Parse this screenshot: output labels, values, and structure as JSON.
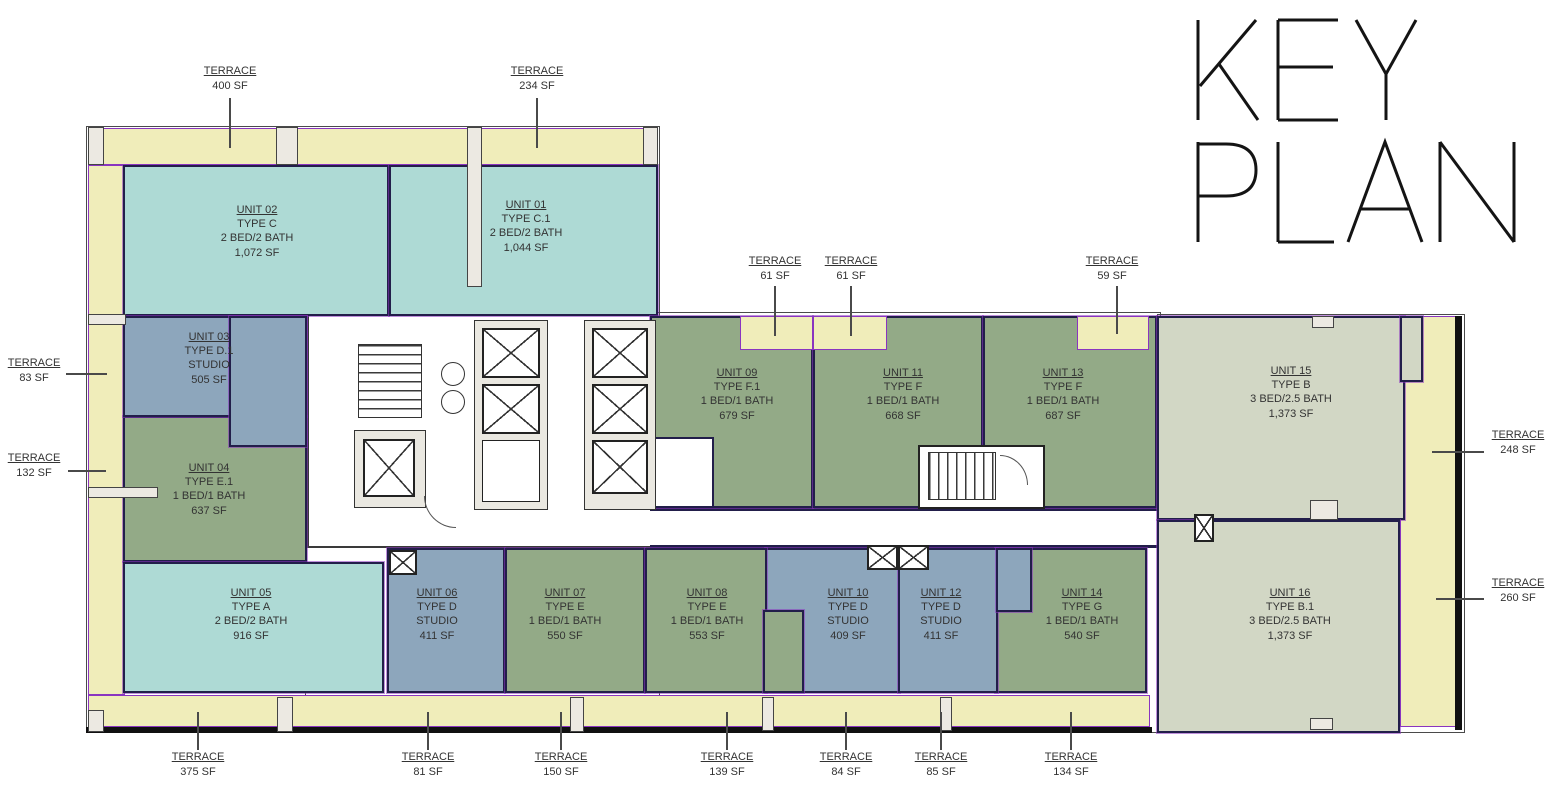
{
  "title": {
    "text": "KEY PLAN",
    "line1": "KEY",
    "line2": "PLAN"
  },
  "colors": {
    "teal": "#aedad5",
    "blue_gray": "#8da6bc",
    "green": "#93aa87",
    "sage": "#d2d7c5",
    "terrace_fill": "#f0edba",
    "wall_navy": "#221e4a",
    "outline_purple": "#8a35c0",
    "label_text": "#333333"
  },
  "units": [
    {
      "name": "UNIT 01",
      "type": "TYPE C.1",
      "layout": "2 BED/2 BATH",
      "area": "1,044 SF",
      "color": "teal"
    },
    {
      "name": "UNIT 02",
      "type": "TYPE C",
      "layout": "2 BED/2 BATH",
      "area": "1,072 SF",
      "color": "teal"
    },
    {
      "name": "UNIT 03",
      "type": "TYPE D.1",
      "layout": "STUDIO",
      "area": "505 SF",
      "color": "blue_gray"
    },
    {
      "name": "UNIT 04",
      "type": "TYPE E.1",
      "layout": "1 BED/1 BATH",
      "area": "637 SF",
      "color": "green"
    },
    {
      "name": "UNIT 05",
      "type": "TYPE A",
      "layout": "2 BED/2 BATH",
      "area": "916 SF",
      "color": "teal"
    },
    {
      "name": "UNIT 06",
      "type": "TYPE D",
      "layout": "STUDIO",
      "area": "411 SF",
      "color": "blue_gray"
    },
    {
      "name": "UNIT 07",
      "type": "TYPE E",
      "layout": "1 BED/1 BATH",
      "area": "550 SF",
      "color": "green"
    },
    {
      "name": "UNIT 08",
      "type": "TYPE E",
      "layout": "1 BED/1 BATH",
      "area": "553 SF",
      "color": "green"
    },
    {
      "name": "UNIT 09",
      "type": "TYPE F.1",
      "layout": "1 BED/1 BATH",
      "area": "679 SF",
      "color": "green"
    },
    {
      "name": "UNIT 10",
      "type": "TYPE D",
      "layout": "STUDIO",
      "area": "409 SF",
      "color": "blue_gray"
    },
    {
      "name": "UNIT 11",
      "type": "TYPE F",
      "layout": "1 BED/1 BATH",
      "area": "668 SF",
      "color": "green"
    },
    {
      "name": "UNIT 12",
      "type": "TYPE D",
      "layout": "STUDIO",
      "area": "411 SF",
      "color": "blue_gray"
    },
    {
      "name": "UNIT 13",
      "type": "TYPE F",
      "layout": "1 BED/1 BATH",
      "area": "687 SF",
      "color": "green"
    },
    {
      "name": "UNIT 14",
      "type": "TYPE G",
      "layout": "1 BED/1 BATH",
      "area": "540 SF",
      "color": "green"
    },
    {
      "name": "UNIT 15",
      "type": "TYPE B",
      "layout": "3 BED/2.5 BATH",
      "area": "1,373 SF",
      "color": "sage"
    },
    {
      "name": "UNIT 16",
      "type": "TYPE B.1",
      "layout": "3 BED/2.5 BATH",
      "area": "1,373 SF",
      "color": "sage"
    }
  ],
  "terraces": [
    {
      "label": "TERRACE",
      "area": "400 SF",
      "position": "top"
    },
    {
      "label": "TERRACE",
      "area": "234 SF",
      "position": "top"
    },
    {
      "label": "TERRACE",
      "area": "61 SF",
      "position": "top-middle"
    },
    {
      "label": "TERRACE",
      "area": "61 SF",
      "position": "top-middle"
    },
    {
      "label": "TERRACE",
      "area": "59 SF",
      "position": "top-middle"
    },
    {
      "label": "TERRACE",
      "area": "83 SF",
      "position": "left"
    },
    {
      "label": "TERRACE",
      "area": "132 SF",
      "position": "left"
    },
    {
      "label": "TERRACE",
      "area": "248 SF",
      "position": "right"
    },
    {
      "label": "TERRACE",
      "area": "260 SF",
      "position": "right"
    },
    {
      "label": "TERRACE",
      "area": "375 SF",
      "position": "bottom"
    },
    {
      "label": "TERRACE",
      "area": "81 SF",
      "position": "bottom"
    },
    {
      "label": "TERRACE",
      "area": "150 SF",
      "position": "bottom"
    },
    {
      "label": "TERRACE",
      "area": "139 SF",
      "position": "bottom"
    },
    {
      "label": "TERRACE",
      "area": "84 SF",
      "position": "bottom"
    },
    {
      "label": "TERRACE",
      "area": "85 SF",
      "position": "bottom"
    },
    {
      "label": "TERRACE",
      "area": "134 SF",
      "position": "bottom"
    }
  ]
}
